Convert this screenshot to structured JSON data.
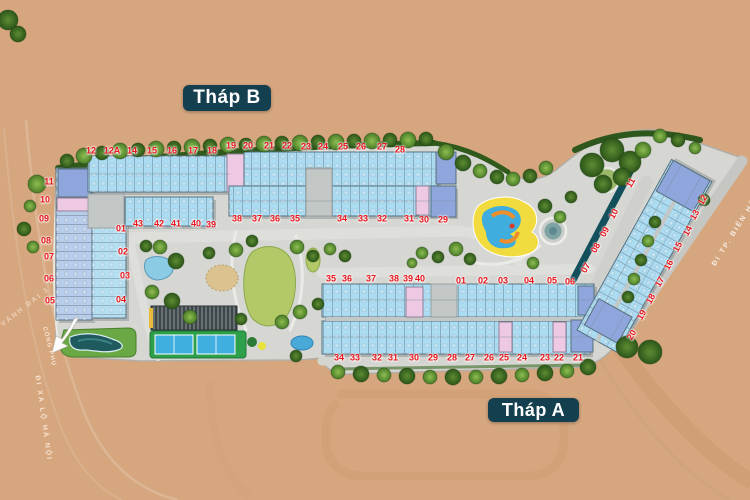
{
  "plan_title": "Site master plan",
  "towers": {
    "b": {
      "label": "Tháp B",
      "units": {
        "top": [
          "12",
          "12A",
          "14",
          "15",
          "16",
          "17",
          "18",
          "19",
          "20",
          "21",
          "22",
          "23",
          "24",
          "25",
          "26",
          "27",
          "28"
        ],
        "mid": [
          "38",
          "37",
          "36",
          "35",
          "34",
          "33",
          "32",
          "31",
          "30",
          "29"
        ],
        "inner": [
          "43",
          "42",
          "41",
          "40",
          "39"
        ],
        "left_outer": [
          "11",
          "10",
          "09",
          "08",
          "07",
          "06",
          "05"
        ],
        "left_inner": [
          "01",
          "02",
          "03",
          "04"
        ]
      }
    },
    "a": {
      "label": "Tháp A",
      "units": {
        "top": [
          "35",
          "36",
          "37",
          "38",
          "39",
          "40",
          "01",
          "02",
          "03",
          "04",
          "05",
          "06"
        ],
        "bottom": [
          "34",
          "33",
          "32",
          "31",
          "30",
          "29",
          "28",
          "27",
          "26",
          "25",
          "24",
          "23",
          "22",
          "21"
        ],
        "diag_left": [
          "11",
          "10",
          "09",
          "08",
          "07"
        ],
        "diag_right": [
          "12",
          "13",
          "14",
          "15",
          "16",
          "17",
          "18",
          "19",
          "20"
        ]
      }
    }
  },
  "streets": {
    "xa_lo_ha_noi": "ĐI XA LỘ HÀ NỘI",
    "vanh_dai_3": "VÀNH ĐAI 3",
    "cong_phu": "CỔNG PHỤ",
    "bien_hoa": "ĐI TP. BIÊN HÒA"
  },
  "colors": {
    "background": "#d6a67e",
    "site": "#d6d7d3",
    "unit_blue": "#abdcf2",
    "unit_periwinkle": "#8ea6dc",
    "unit_pink": "#eec9e3",
    "number_red": "#e8151c",
    "badge_navy": "#143f4e",
    "lawn_green": "#b3c967",
    "pool_teal": "#215c60",
    "hedge_green": "#2f5a1c"
  }
}
